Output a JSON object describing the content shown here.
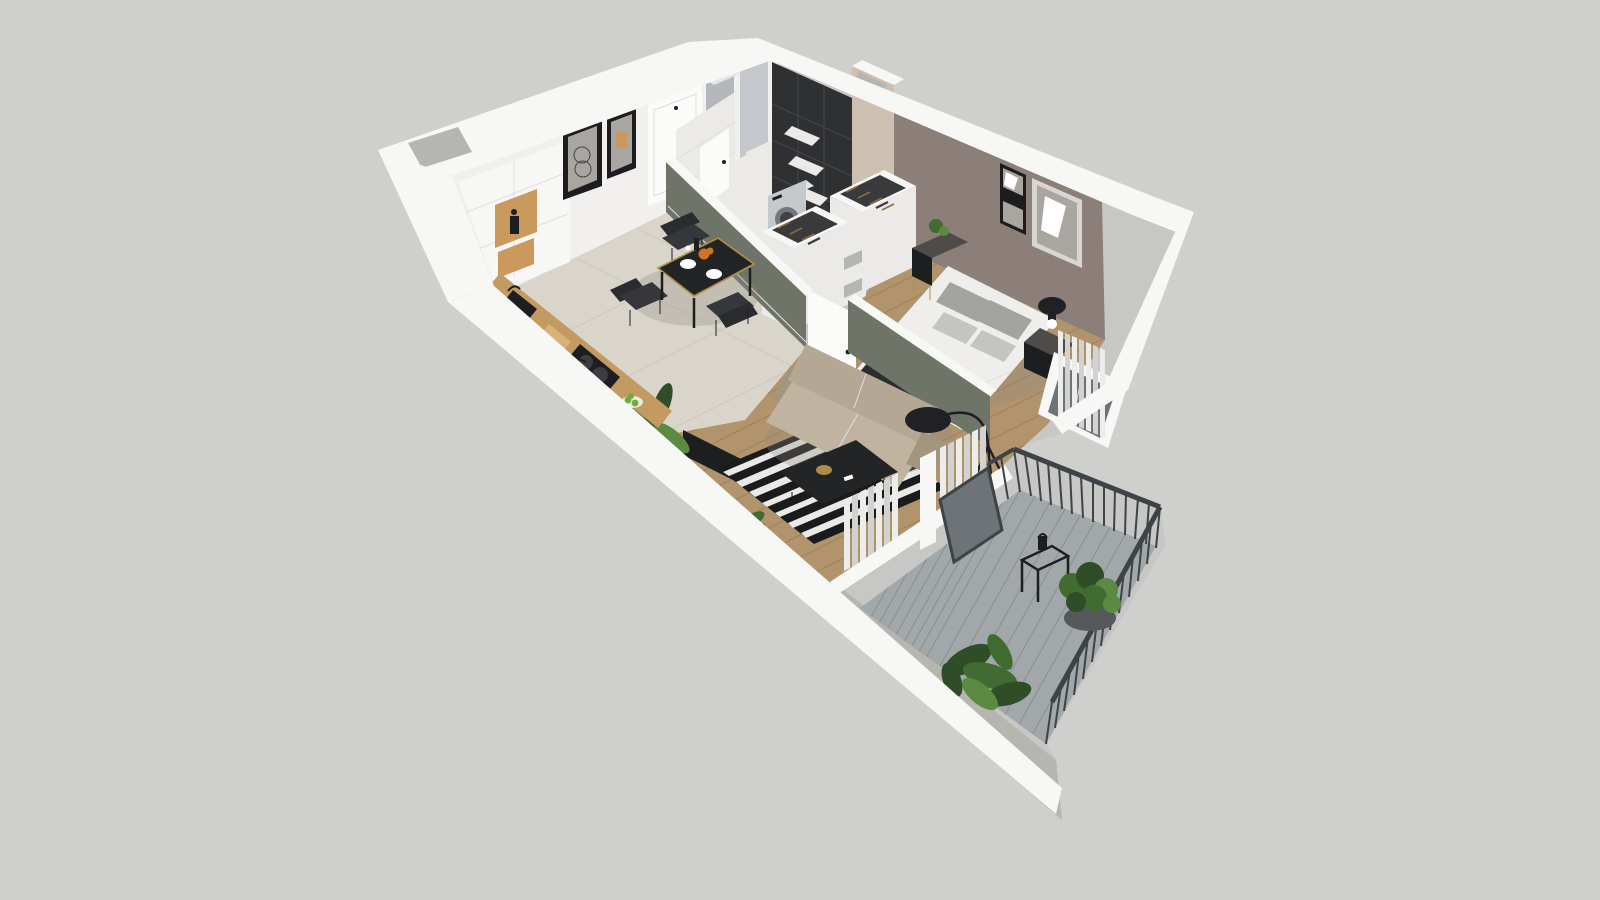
{
  "scene": {
    "kind": "isometric-3d-apartment-floor-plan-render",
    "rooms": [
      {
        "name": "kitchen-dining",
        "floor": "beige-tile",
        "furniture": [
          "kitchen-cabinets",
          "wood-niche-with-coffee-maker",
          "counter-with-sink",
          "cooktop-with-pans",
          "cutting-board",
          "fruit-bowl",
          "dining-table",
          "dining-chairs",
          "framed-art-pair",
          "entry-door",
          "entry-wardrobe-panels",
          "palm-plant"
        ]
      },
      {
        "name": "bathroom-laundry",
        "floor": "white-tile",
        "furniture": [
          "washing-machine",
          "black-tile-wall",
          "wall-shelves",
          "bathroom-door"
        ]
      },
      {
        "name": "wardrobe-corridor",
        "floor": "wood",
        "furniture": [
          "open-wardrobe-units",
          "hanging-clothes",
          "storage-boxes",
          "corridor-door"
        ]
      },
      {
        "name": "bedroom",
        "floor": "wood",
        "furniture": [
          "double-bed",
          "gray-pillows",
          "dark-throw",
          "nightstand-left-with-plant",
          "nightstand-right-with-lamp",
          "framed-art-pair",
          "curtains",
          "window"
        ]
      },
      {
        "name": "living-room",
        "floor": "wood",
        "furniture": [
          "beige-sofa",
          "striped-rug",
          "black-coffee-table",
          "floor-lamp",
          "tv-panel",
          "small-plant",
          "curtains",
          "sliding-door"
        ]
      },
      {
        "name": "balcony",
        "floor": "gray-decking",
        "furniture": [
          "metal-railing",
          "wire-side-table",
          "lantern",
          "potted-plant",
          "leafy-plant"
        ]
      }
    ]
  },
  "colors": {
    "background": "#cfcfce",
    "wallOuter": "#c7c7c5",
    "wallCap": "#f7f7f5",
    "wallInner": "#f1f0ee",
    "wallHole": "#b5b5b3",
    "floorTile": "#d9d5cb",
    "tileLine": "#cbc7bd",
    "floorWood": "#b2946c",
    "woodLine": "#a0825c",
    "whiteTile": "#eceae6",
    "sageWall": "#6f7468",
    "mauveWall": "#8c7e79",
    "tanWall": "#cec0b1",
    "blackTile": "#2e3032",
    "groutDark": "#44464a",
    "counterWood": "#c49a63",
    "accentWood": "#c9995d",
    "applianceBody": "#c6c9cc",
    "applianceTop": "#e3e5e6",
    "doorWhite": "#fbfbf9",
    "grayCabinet": "#b4b8bc",
    "grayCabinet2": "#c4c8cc",
    "sofaBeige": "#b4a894",
    "sofaBeigeDark": "#a2967f",
    "sofaSeat": "#c0b4a1",
    "rugBlack": "#1a1b1d",
    "rugWhite": "#e9e9e7",
    "tableBlack": "#232426",
    "goldTrim": "#b28f4a",
    "chairDark": "#35373b",
    "chairBack": "#2a2c2f",
    "bedWhite": "#efeeec",
    "pillowGray": "#a3a3a1",
    "pillowLight": "#c4c4c2",
    "throwDark": "#2c2d2f",
    "curtainLight": "#ececea",
    "curtainShade": "#d2d2d0",
    "railDark": "#3d4347",
    "deckGray": "#a2a7aa",
    "deckLine": "#8d9295",
    "glassGray": "#6e7377",
    "plantDark": "#2f4d26",
    "plantMid": "#426b31",
    "plantLight": "#5c8a43",
    "frameDark": "#1d1d1f",
    "frameLight": "#d8d6d2",
    "photoGray": "#a9a5a0",
    "lampBlack": "#202124",
    "boxWhite": "#eceae8",
    "nightstandDark": "#4e4b49",
    "appleGreen": "#6fae35",
    "orangeFruit": "#d2731f",
    "darkMetal": "#1d1e20",
    "potGray": "#55595b",
    "hangerWood": "#8a6a3e",
    "clothDark": "#3a3a3c",
    "seamLight": "#e0dfdd",
    "shadowTint": "#8e8a82"
  }
}
